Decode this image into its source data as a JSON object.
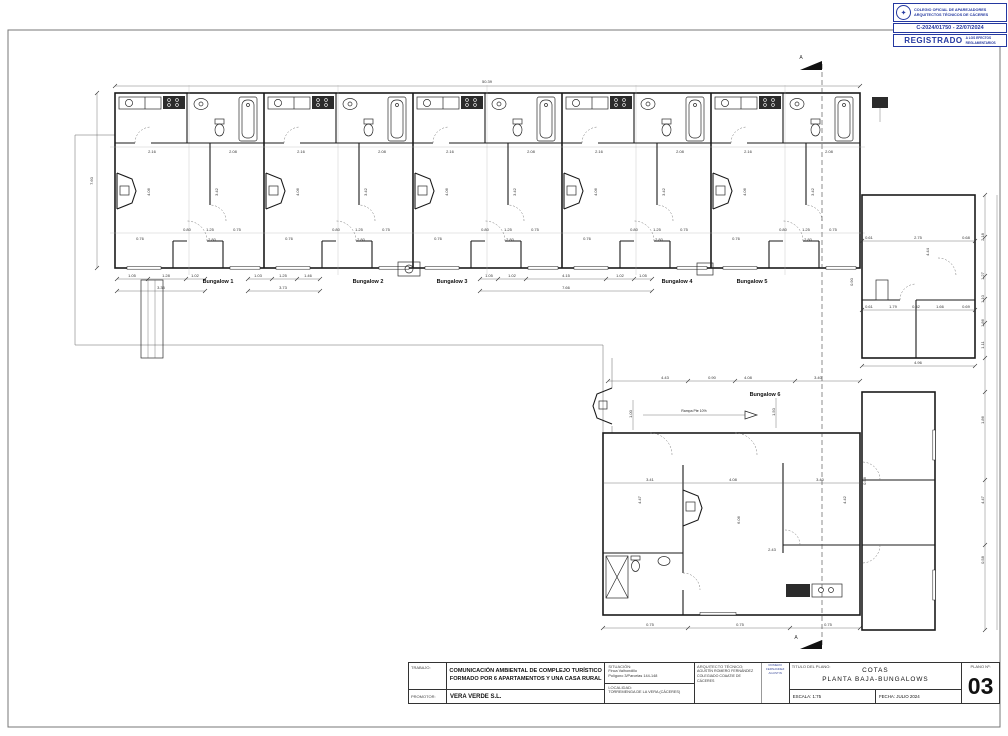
{
  "stamp": {
    "org_line1": "COLEGIO OFICIAL DE APAREJADORES",
    "org_line2": "ARQUITECTOS TÉCNICOS DE CÁCERES",
    "crest_icon": "stamp-crest",
    "registry": "C-2024/01750 - 22/07/2024",
    "registered": "REGISTRADO",
    "note1": "A LOS EFECTOS",
    "note2": "REGLAMENTARIOS",
    "accent_color": "#2438a0"
  },
  "title_block": {
    "trabajo_label": "TRABAJO:",
    "trabajo_line1": "COMUNICACIÓN AMBIENTAL DE COMPLEJO TURÍSTICO",
    "trabajo_line2": "FORMADO POR 6 APARTAMENTOS Y UNA CASA RURAL",
    "promotor_label": "PROMOTOR:",
    "promotor": "VERA VERDE S.L.",
    "situacion_label": "SITUACIÓN:",
    "situacion_line1": "Finca Valhondillo",
    "situacion_line2": "Polígono 3/Parcelas 144-148",
    "localidad_label": "LOCALIDAD:",
    "localidad": "TORREMENGA DE LA VERA (CÁCERES)",
    "arquitecto_label": "ARQUITECTO TÉCNICO:",
    "arquitecto_line1": "AGUSTÍN ROMERO FERNÁNDEZ",
    "arquitecto_line2": "COLEGIADO COAATIE DE",
    "arquitecto_line3": "CÁCERES",
    "firma_line1": "ROMERO",
    "firma_line2": "FERNANDEZ",
    "firma_line3": "AGUSTIN",
    "titulo_label": "TITULO DEL PLANO:",
    "titulo_line1": "COTAS",
    "titulo_line2": "PLANTA BAJA-BUNGALOWS",
    "escala": "ESCALA:  1:75",
    "fecha": "FECHA: JULIO 2024",
    "plano_label": "PLANO Nº:",
    "plano_num": "03"
  },
  "plan": {
    "section_letter": "A",
    "ramp_note": "Rampa Pte 10%",
    "bungalow_labels": [
      "Bungalow 1",
      "Bungalow 2",
      "Bungalow 3",
      "Bungalow 4",
      "Bungalow 5",
      "Bungalow 6"
    ],
    "dims": {
      "total_top": "50.39",
      "left_height": "7.60",
      "u_a1": "1.05",
      "u_a2": "1.28",
      "u_a3": "1.02",
      "u_a_total": "3.35",
      "u_b1": "1.03",
      "u_b2": "1.25",
      "u_b3": "1.46",
      "u_b_total": "3.73",
      "u_c1": "1.05",
      "u_c2": "1.02",
      "u_c3": "4.15",
      "u_c4": "1.02",
      "u_c5": "1.05",
      "u_c_total": "7.66",
      "kitchen_w": "2.16",
      "bath_w": "2.08",
      "living_h": "4.06",
      "bed_h": "3.42",
      "porch_a": "0.80",
      "porch_b": "1.25",
      "porch_c": "0.75",
      "porch_total": "2.80",
      "win_a": "0.76",
      "rb_top1": "0.61",
      "rb_top2": "2.75",
      "rb_top3": "0.68",
      "rb_h": "4.44",
      "rb_mid1": "0.61",
      "rb_mid2": "1.79",
      "rb_mid3": "0.52",
      "rb_mid4": "1.66",
      "rb_mid5": "0.69",
      "rb_total": "4.96",
      "rb_r1": "2.18",
      "rb_r2": "1.27",
      "rb_r3": "1.10",
      "rb_r4": "1.86",
      "rb_r5": "1.11",
      "gap": "0.90",
      "b6_t1": "4.43",
      "b6_t2": "0.90",
      "b6_t3": "4.08",
      "b6_t4": "3.40",
      "b6_m1": "3.41",
      "b6_m2": "4.08",
      "b6_m3": "3.40",
      "b6_m4": "0.58",
      "b6_v1": "4.47",
      "b6_v2": "6.06",
      "b6_v3": "4.42",
      "b6_k": "2.43",
      "b6_w": "0.75",
      "b6_ramp_a": "1.00",
      "b6_ramp_b": "1.50",
      "lr_r1": "1.86",
      "lr_r2": "4.47",
      "lr_r3": "0.58"
    }
  }
}
